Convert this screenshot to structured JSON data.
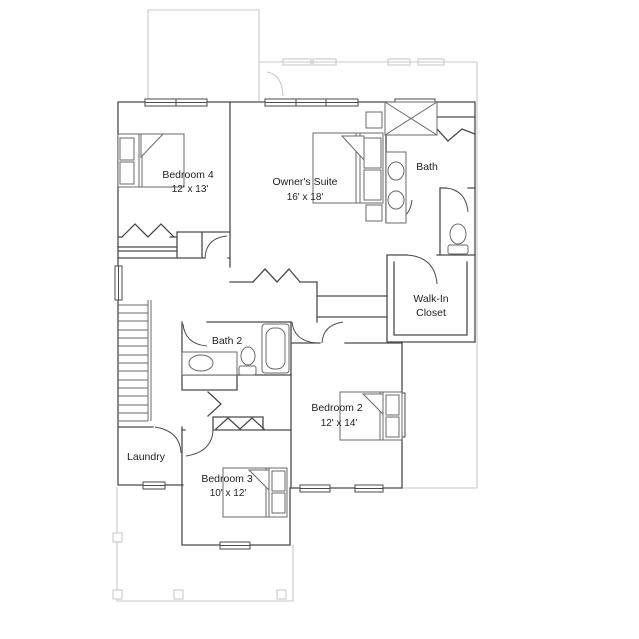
{
  "colors": {
    "wall": "#4a4a4a",
    "lower_floor_outline": "#c9c9c9",
    "background": "#ffffff",
    "label_text": "#1f1f1f"
  },
  "rooms": {
    "bedroom4": {
      "label": "Bedroom 4",
      "dimensions": "12' x 13'"
    },
    "owners_suite": {
      "label": "Owner's Suite",
      "dimensions": "16' x 18'"
    },
    "bath": {
      "label": "Bath"
    },
    "walk_in_closet": {
      "label_line1": "Walk-In",
      "label_line2": "Closet"
    },
    "bath2": {
      "label": "Bath 2"
    },
    "bedroom2": {
      "label": "Bedroom 2",
      "dimensions": "12' x 14'"
    },
    "laundry": {
      "label": "Laundry"
    },
    "bedroom3": {
      "label": "Bedroom 3",
      "dimensions": "10' x 12'"
    }
  }
}
